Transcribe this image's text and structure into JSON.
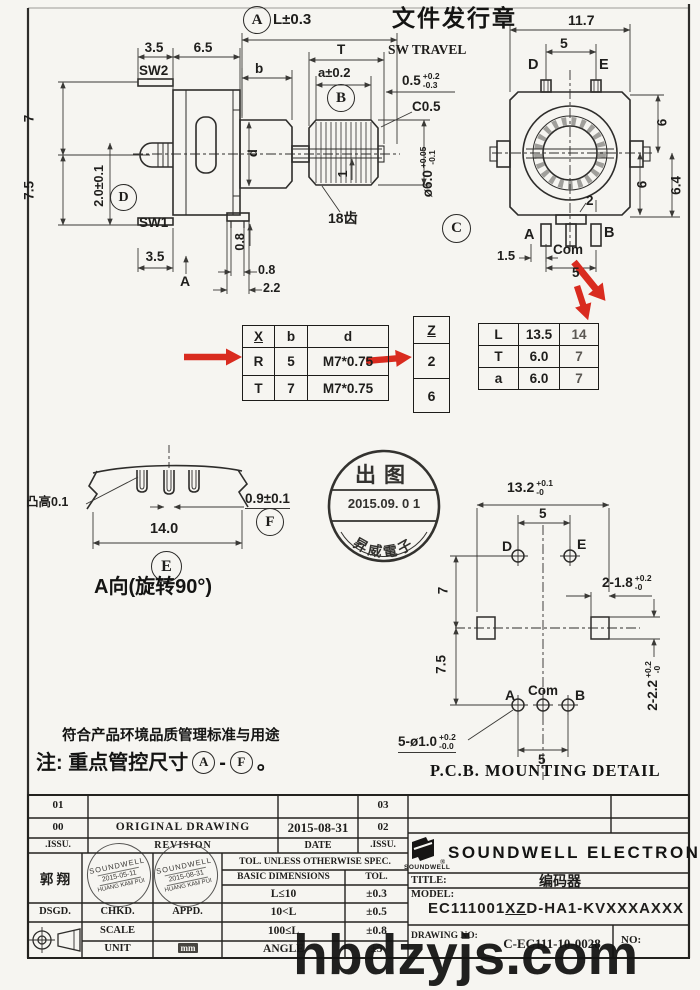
{
  "header": {
    "release_title": "文件发行章"
  },
  "watermark": {
    "text": "hbdzyjs.com"
  },
  "balloons": {
    "a": "A",
    "b": "B",
    "c": "C",
    "d": "D",
    "e": "E",
    "f": "F"
  },
  "side_view": {
    "dim_l": "L±0.3",
    "dim_35_top": "3.5",
    "dim_65": "6.5",
    "sw2": "SW2",
    "dim_b": "b",
    "dim_t": "T",
    "dim_a": "a±0.2",
    "sw_travel": "SW TRAVEL",
    "dim_05": "0.5",
    "dim_05_up": "+0.2",
    "dim_05_dn": "-0.3",
    "chamfer": "C0.5",
    "dim_7": "7",
    "dim_75": "7.5",
    "dim_20": "2.0±0.1",
    "sw1": "SW1",
    "dim_35_bot": "3.5",
    "section_label": "A",
    "dim_d": "d",
    "dim_1": "1",
    "dim_08_v": "0.8",
    "dim_08_h": "0.8",
    "dim_22": "2.2",
    "teeth": "18齿",
    "dia": "ø6.0",
    "dia_up": "+0.05",
    "dia_dn": "-0.1"
  },
  "front_view": {
    "dim_117": "11.7",
    "dim_5_top": "5",
    "pin_d": "D",
    "pin_e": "E",
    "dim_6_right": "6",
    "dim_6_inner": "6",
    "dim_64": "6.4",
    "dim_2": "2",
    "pin_a": "A",
    "pin_com": "Com",
    "pin_b": "B",
    "dim_15": "1.5",
    "dim_5_bot": "5"
  },
  "xbd_table": {
    "headers": [
      "X",
      "b",
      "d"
    ],
    "rows": [
      [
        "R",
        "5",
        "M7*0.75"
      ],
      [
        "T",
        "7",
        "M7*0.75"
      ]
    ]
  },
  "z_table": {
    "header": "Z",
    "values": [
      "2",
      "6"
    ]
  },
  "lta_table": {
    "rows": [
      [
        "L",
        "13.5",
        "14"
      ],
      [
        "T",
        "6.0",
        "7"
      ],
      [
        "a",
        "6.0",
        "7"
      ]
    ]
  },
  "release_stamp": {
    "top": "出图",
    "date": "2015.09. 0 1",
    "bottom": "昇威電子"
  },
  "a_view": {
    "bump": "凸高0.1",
    "dim_09": "0.9±0.1",
    "dim_14": "14.0",
    "caption": "A向(旋转90°)"
  },
  "pcb_view": {
    "dim_132": "13.2",
    "dim_132_up": "+0.1",
    "dim_132_dn": "-0",
    "dim_5_top": "5",
    "hole_d": "D",
    "hole_e": "E",
    "dim_7": "7",
    "dim_75": "7.5",
    "dim_218": "2-1.8",
    "dim_218_up": "+0.2",
    "dim_218_dn": "-0",
    "dim_222": "2-2.2",
    "dim_222_up": "+0.2",
    "dim_222_dn": "-0",
    "hole_a": "A",
    "hole_com": "Com",
    "hole_b": "B",
    "dim_510": "5-ø1.0",
    "dim_510_up": "+0.2",
    "dim_510_dn": "-0.0",
    "dim_5_bot": "5",
    "caption": "P.C.B. MOUNTING DETAIL"
  },
  "notes": {
    "line1": "符合产品环境品质管理标准与用途",
    "line2_pre": "注: 重点管控尺寸",
    "dash": "-",
    "period": "。"
  },
  "title_block": {
    "rev": {
      "row1_no": "01",
      "row1_no2": "03",
      "row2_no": "00",
      "row2_desc": "ORIGINAL DRAWING",
      "row2_date": "2015-08-31",
      "row2_no2": "02",
      "issu": ".ISSU.",
      "revision": "REVISION",
      "date": "DATE",
      "issu2": ".ISSU."
    },
    "designer": "郭 翔",
    "stamps": [
      {
        "l1": "SOUNDWELL",
        "l2": "2015-05-11",
        "l3": "HUANG KAM PUI"
      },
      {
        "l1": "SOUNDWELL",
        "l2": "2015-08-31",
        "l3": "HUANG KAM PUI"
      }
    ],
    "dsgd": "DSGD.",
    "chkd": "CHKD.",
    "appd": "APPD.",
    "scale_label": "SCALE",
    "unit_label": "UNIT",
    "unit_value": "mm",
    "tol_header": "TOL. UNLESS OTHERWISE SPEC.",
    "basic_label": "BASIC DIMENSIONS",
    "tol_label": "TOL.",
    "tol_rows": [
      [
        "L≤10",
        "±0.3"
      ],
      [
        "10<L",
        "±0.5"
      ],
      [
        "100≤L",
        "±0.8"
      ],
      [
        "ANGLE",
        "±5"
      ]
    ],
    "logo_text": "SOUNDWELL",
    "logo_reg": "®",
    "company": "SOUNDWELL ELECTRONICS",
    "title_label": "TITLE:",
    "title_value": "编码器",
    "model_label": "MODEL:",
    "model_p1": "EC111001",
    "model_p2": "XZ",
    "model_p3": "D-HA1-KVXXXAXXX",
    "drawing_label": "DRAWING NO:",
    "drawing_value": "C-EC111-10-0028",
    "no_label": "NO:"
  },
  "colors": {
    "red": "#d92b1f",
    "line": "#2e2d2b",
    "paper": "#f6f5f1"
  }
}
